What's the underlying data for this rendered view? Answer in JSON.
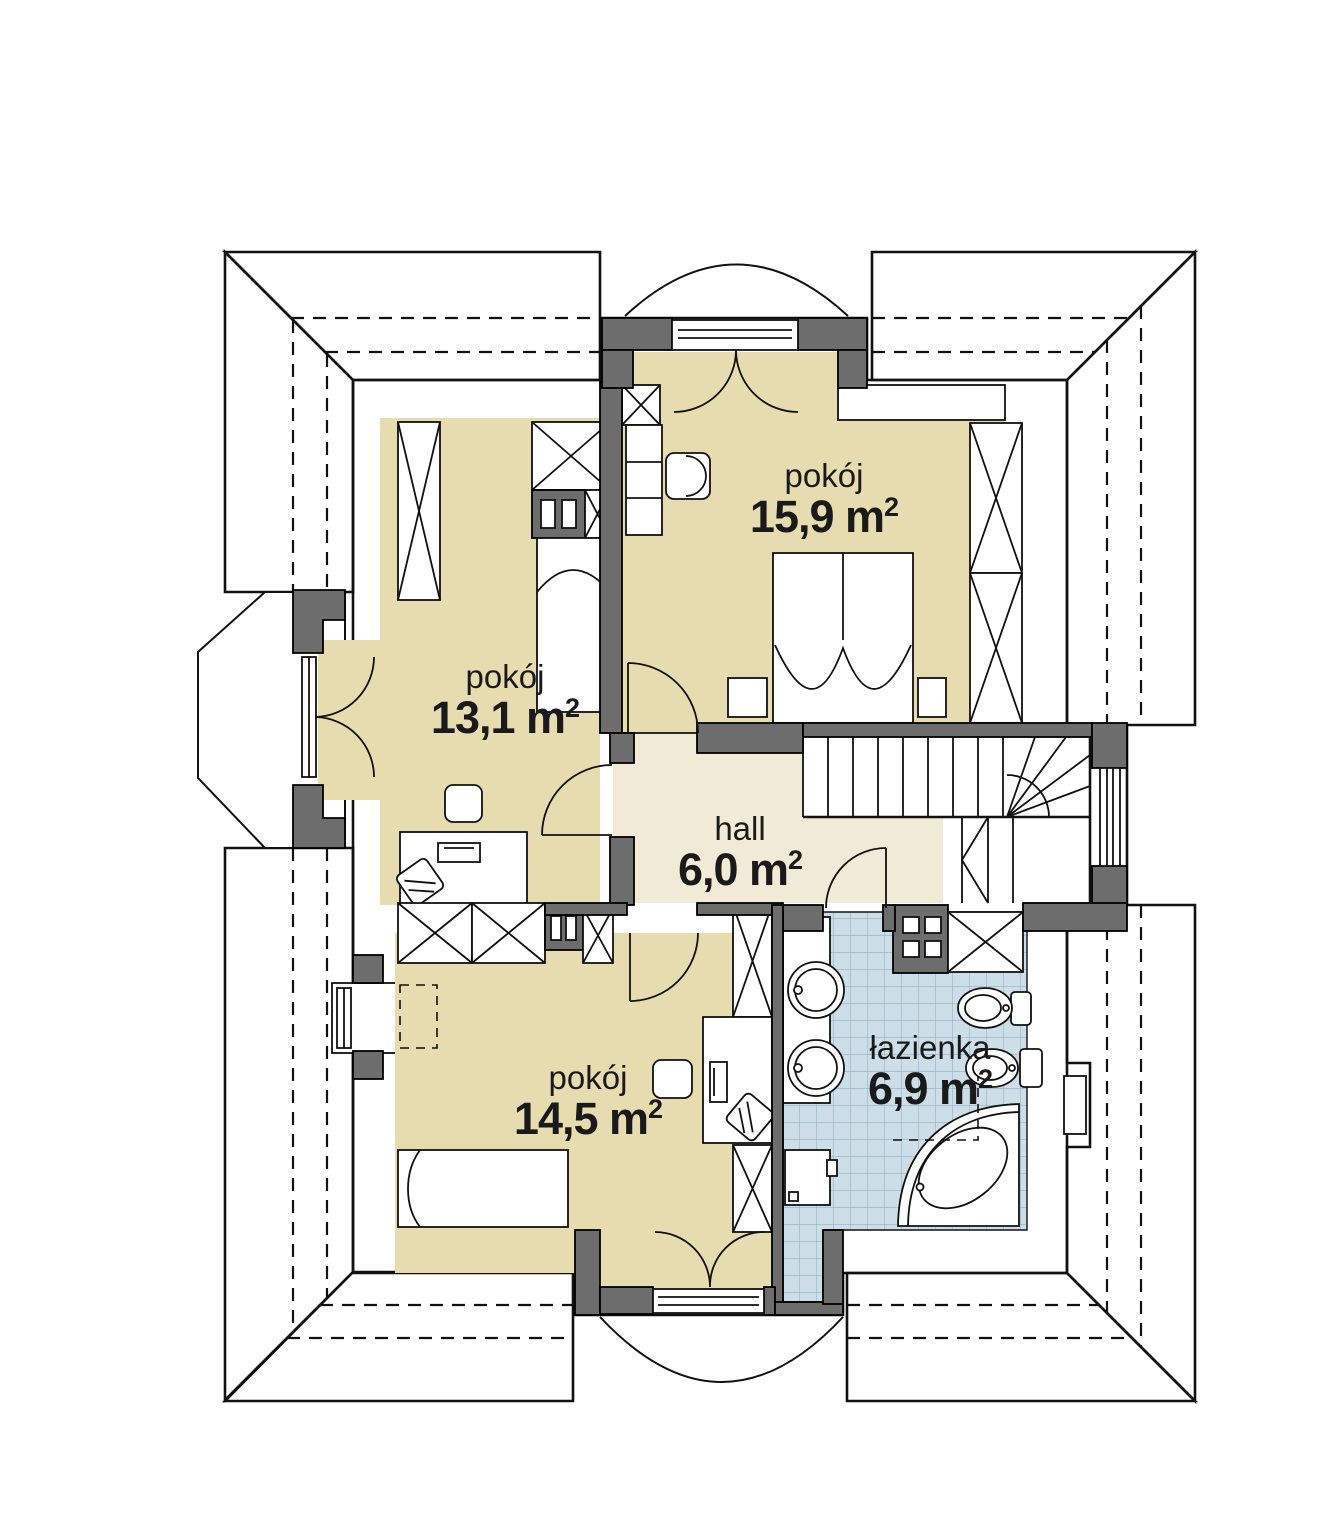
{
  "plan": {
    "title": "attic floor plan",
    "unit": {
      "base": "m",
      "sup": "2"
    },
    "rooms": [
      {
        "id": "room-15-9",
        "name": "pokój",
        "area": "15,9"
      },
      {
        "id": "room-13-1",
        "name": "pokój",
        "area": "13,1"
      },
      {
        "id": "hall",
        "name": "hall",
        "area": "6,0"
      },
      {
        "id": "room-14-5",
        "name": "pokój",
        "area": "14,5"
      },
      {
        "id": "bathroom",
        "name": "łazienka",
        "area": "6,9"
      }
    ],
    "colors": {
      "room_floor": "#e6dcb0",
      "hall_floor": "#f1ead6",
      "bath_tile": "#cddee9",
      "tile_grid": "#93b2c7",
      "wall_poche": "#6d6d6d",
      "roof_dark": "#a9a9a9",
      "roof_light": "#d7d7d7",
      "roof_medium": "#b7b7b7",
      "line": "#111111"
    },
    "symbols": [
      "wardrobe-icon",
      "double-bed-icon",
      "single-bed-icon",
      "desk-icon",
      "office-chair-icon",
      "monitor-icon",
      "chimney-icon",
      "washbasin-icon",
      "sink-icon",
      "toilet-icon",
      "bidet-icon",
      "corner-bathtub-icon",
      "washing-machine-icon",
      "staircase",
      "door-swing",
      "french-door",
      "window",
      "balcony",
      "roof-plane"
    ]
  }
}
